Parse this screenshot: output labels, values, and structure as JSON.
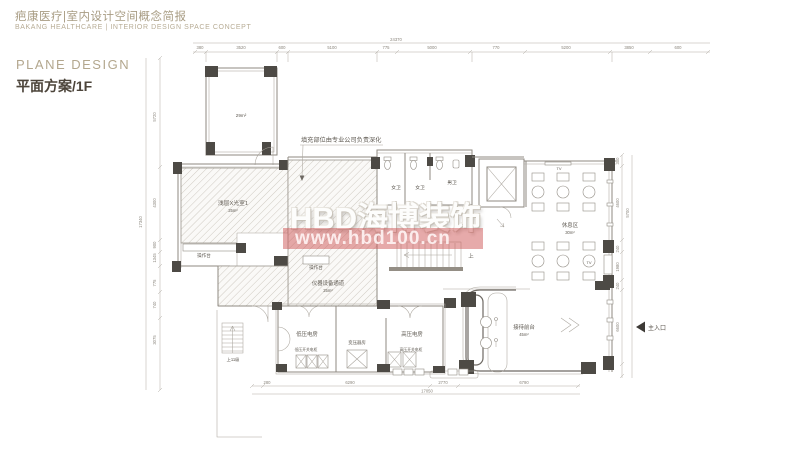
{
  "header": {
    "title_cn": "疤康医疗|室内设计空间概念简报",
    "title_en": "BAKANG HEALTHCARE | INTERIOR DESIGN SPACE CONCEPT"
  },
  "section": {
    "label_en": "PLANE DESIGN",
    "label_cn": "平面方案/1F"
  },
  "watermark": {
    "brand": "HBD海博装饰",
    "url": "www.hbd100.cn",
    "banner_color": "#cd5555"
  },
  "plan": {
    "annotation": "填充部位由专业公司负责深化",
    "rooms": {
      "top_room_area": "29m²",
      "xray_name": "浅层X光室1",
      "xray_area": "25m²",
      "counter_left": "操作台",
      "counter_right": "操作台",
      "equip_name": "仪器设备通道",
      "equip_area": "25m²",
      "wc_f1": "女卫",
      "wc_f2": "女卫",
      "wc_m": "男卫",
      "rest_name": "休息区",
      "rest_area": "30m²",
      "tv_top": "TV",
      "tv_side": "TV",
      "stair_up": "上",
      "stair_11": "上11级",
      "lv_room": "低压电房",
      "lv_cabinet": "低压开关电柜",
      "transformer_room": "变压器房",
      "hv_room": "高压电房",
      "hv_cabinet": "高压开关电柜",
      "reception_name": "接待前台",
      "reception_area": "45m²",
      "entrance": "主入口"
    },
    "dims": {
      "top": [
        "380",
        "3520",
        "600",
        "5100",
        "775",
        "5000",
        "770",
        "5200",
        "3850",
        "600"
      ],
      "top_total": "24370",
      "left": [
        "5720",
        "4300",
        "900",
        "1345",
        "775",
        "740",
        "3075"
      ],
      "left_total": "17340",
      "right": [
        "300",
        "4600",
        "240",
        "1980",
        "240",
        "6600"
      ],
      "right_mid": "5700",
      "bottom": [
        "280",
        "6290",
        "2770",
        "6790"
      ],
      "bottom_total": "17050"
    }
  }
}
